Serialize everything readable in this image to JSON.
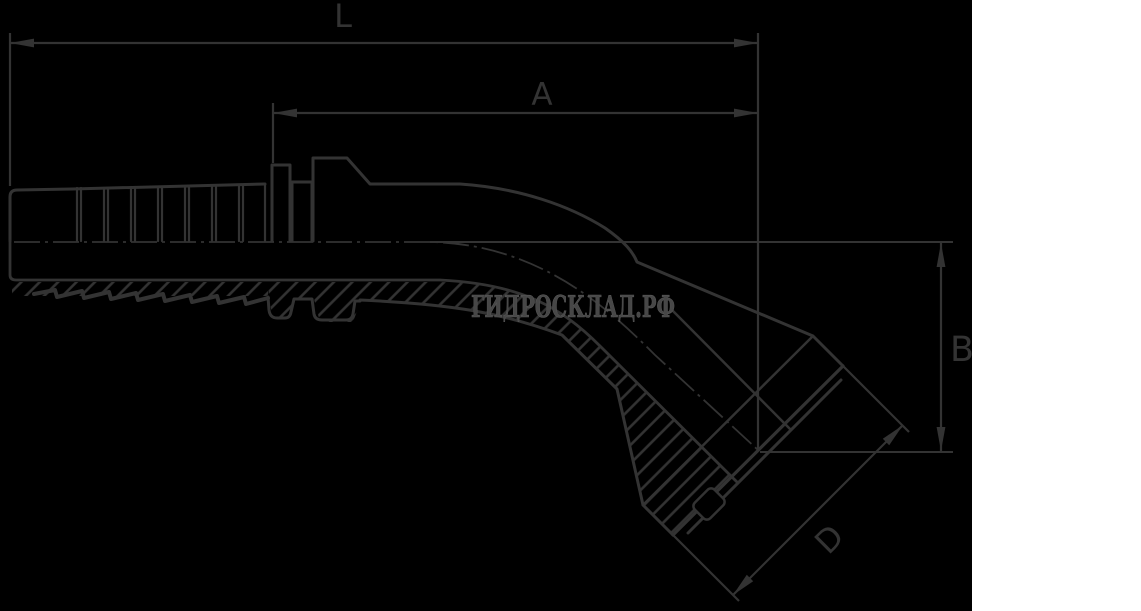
{
  "watermark": {
    "text": "ГИДРОСКЛАД.РФ",
    "color": "#474747"
  },
  "dimensions": {
    "overall_length_label": "L",
    "tail_length_label": "A",
    "drop_height_label": "B",
    "flange_diameter_label": "D"
  },
  "colors": {
    "line": "#333333",
    "background": "#000000",
    "side_panel": "#ffffff"
  }
}
